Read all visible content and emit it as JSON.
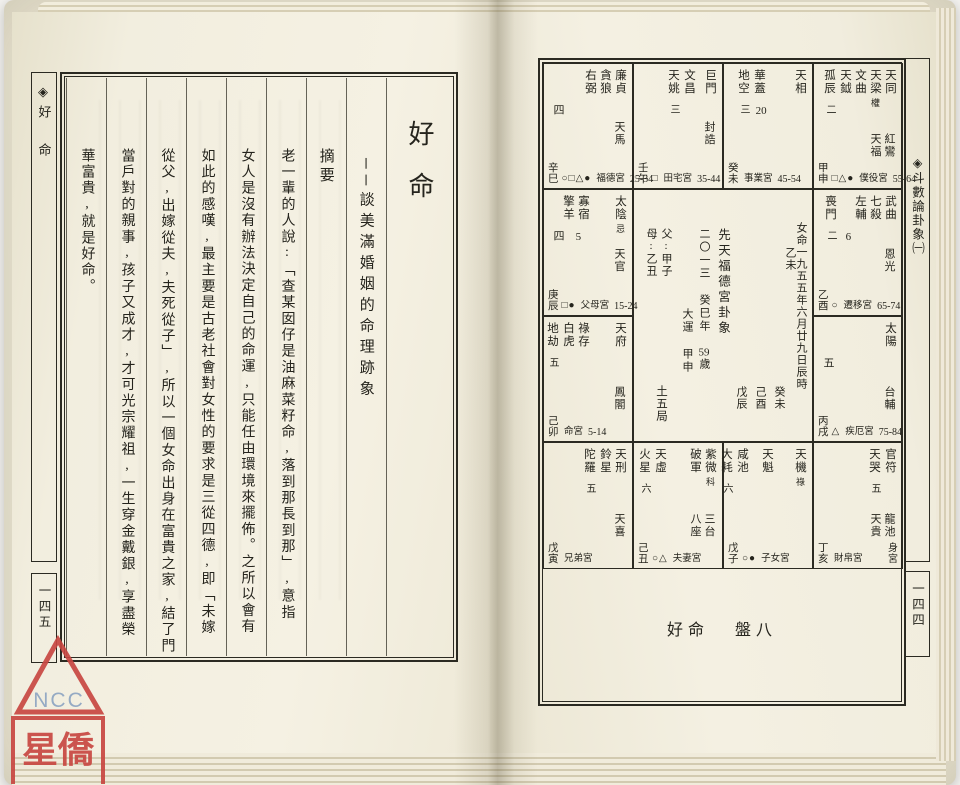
{
  "left_page": {
    "margin_label": "◈好 命",
    "page_number": "一四五",
    "title": "好命",
    "subtitle": "──談美滿婚姻的命理跡象",
    "section_header": "摘要",
    "body_columns": [
      "老一輩的人說:「查某囡仔是油麻菜籽命,落到那長到那」,意指",
      "女人是沒有辦法決定自己的命運,只能任由環境來擺佈。之所以會有",
      "如此的感嘆,最主要是古老社會對女性的要求是三從四德,即「未嫁",
      "從父,出嫁從夫,夫死從子」,所以一個女命出身在富貴之家,結了門",
      "當戶對的親事,孩子又成才,才可光宗耀祖,一生穿金戴銀,享盡榮",
      "華富貴,就是好命。"
    ]
  },
  "right_page": {
    "margin_label": "◈斗數論卦象㈠",
    "page_number": "一四四",
    "caption_title": "好命",
    "caption_plate": "盤八",
    "chart": {
      "center": {
        "birth_info": "女命一九五五年六月廿九日辰時",
        "year_pillar": "乙未",
        "pillars": [
          "癸未",
          "己酉",
          "戊辰"
        ],
        "heading": "先天福德宮卦象",
        "flow_year": "二〇一三 癸巳年",
        "age": "59",
        "age_suffix": "歲",
        "decade_label": "大運",
        "decade_ganzhi": "甲申",
        "father": "父:甲子",
        "mother": "母:乙丑",
        "bureau": "土五局"
      },
      "palaces": [
        {
          "col": 0,
          "row": 0,
          "gz": "辛巳",
          "stars": [
            {
              "t": "廉貞"
            },
            {
              "t": "貪狼"
            },
            {
              "t": "右弼"
            }
          ],
          "extras": [
            {
              "t": "四",
              "pos": "tl"
            },
            {
              "t": "天馬",
              "pos": "mr"
            }
          ],
          "syms": "○□△●",
          "palace": "福德宮",
          "range": "25-34"
        },
        {
          "col": 1,
          "row": 0,
          "gz": "壬午",
          "stars": [
            {
              "t": "巨門",
              "gap": 6
            },
            {
              "t": "文昌"
            },
            {
              "t": "天姚",
              "num": "三"
            }
          ],
          "extras": [
            {
              "t": "封誥",
              "pos": "mr"
            }
          ],
          "syms": "□",
          "palace": "田宅宮",
          "range": "35-44"
        },
        {
          "col": 2,
          "row": 0,
          "gz": "癸未",
          "stars": [
            {
              "t": "天相",
              "gap": 26
            },
            {
              "t": "華蓋"
            },
            {
              "t": "地空",
              "num": "三"
            }
          ],
          "extras": [
            {
              "t": "20",
              "pos": "tm"
            }
          ],
          "syms": "",
          "palace": "事業宮",
          "range": "45-54"
        },
        {
          "col": 3,
          "row": 0,
          "gz": "甲申",
          "stars": [
            {
              "t": "天同"
            },
            {
              "t": "天梁",
              "sub": "權"
            },
            {
              "t": "文曲"
            },
            {
              "t": "天鉞"
            },
            {
              "t": "孤辰",
              "num": "二"
            }
          ],
          "extras": [
            {
              "t": "紅鸞",
              "pos": "lr"
            },
            {
              "t": "天福",
              "pos": "lr2"
            }
          ],
          "syms": "□△●",
          "palace": "僕役宮",
          "range": "55-64"
        },
        {
          "col": 0,
          "row": 1,
          "gz": "庚辰",
          "stars": [
            {
              "t": "太陰",
              "sub": "忌",
              "gap": 22
            },
            {
              "t": "寡宿"
            },
            {
              "t": "擎羊"
            }
          ],
          "extras": [
            {
              "t": "四",
              "pos": "tl"
            },
            {
              "t": "5",
              "pos": "tm"
            },
            {
              "t": "天官",
              "pos": "mr"
            }
          ],
          "syms": "□●",
          "palace": "父母宮",
          "range": "15-24"
        },
        {
          "col": 3,
          "row": 1,
          "gz": "乙酉",
          "stars": [
            {
              "t": "武曲"
            },
            {
              "t": "七殺"
            },
            {
              "t": "左輔",
              "gap": 14
            },
            {
              "t": "喪門",
              "num": "二"
            }
          ],
          "extras": [
            {
              "t": "6",
              "pos": "tm"
            },
            {
              "t": "恩光",
              "pos": "mr"
            }
          ],
          "syms": "○",
          "palace": "遷移宮",
          "range": "65-74"
        },
        {
          "col": 0,
          "row": 2,
          "gz": "己卯",
          "stars": [
            {
              "t": "天府",
              "gap": 22
            },
            {
              "t": "祿存"
            },
            {
              "t": "白虎"
            },
            {
              "t": "地劫",
              "num": "五"
            }
          ],
          "extras": [
            {
              "t": "鳳閣",
              "pos": "lr"
            }
          ],
          "syms": "",
          "palace": "命宮",
          "range": "5-14"
        },
        {
          "col": 3,
          "row": 2,
          "gz": "丙戌",
          "stars": [
            {
              "t": "太陽"
            }
          ],
          "extras": [
            {
              "t": "五",
              "pos": "tl"
            },
            {
              "t": "台輔",
              "pos": "lr"
            }
          ],
          "syms": "△",
          "palace": "疾厄宮",
          "range": "75-84"
        },
        {
          "col": 0,
          "row": 3,
          "gz": "戊寅",
          "stars": [
            {
              "t": "天刑"
            },
            {
              "t": "鈴星"
            },
            {
              "t": "陀羅",
              "num": "五"
            }
          ],
          "extras": [
            {
              "t": "天喜",
              "pos": "lr"
            }
          ],
          "syms": "",
          "palace": "兄弟宮",
          "range": ""
        },
        {
          "col": 1,
          "row": 3,
          "gz": "己丑",
          "stars": [
            {
              "t": "紫微",
              "sub": "科"
            },
            {
              "t": "破軍",
              "gap": 20
            },
            {
              "t": "天虛"
            },
            {
              "t": "火星",
              "num": "六"
            }
          ],
          "extras": [
            {
              "t": "三台",
              "pos": "lr"
            },
            {
              "t": "八座",
              "pos": "lr2"
            }
          ],
          "syms": "○△",
          "palace": "夫妻宮",
          "range": ""
        },
        {
          "col": 2,
          "row": 3,
          "gz": "戊子",
          "stars": [
            {
              "t": "天機",
              "sub": "祿",
              "gap": 18
            },
            {
              "t": "天魁",
              "gap": 10
            },
            {
              "t": "咸池"
            },
            {
              "t": "大耗",
              "num": "六"
            }
          ],
          "extras": [],
          "syms": "○●",
          "palace": "子女宮",
          "range": ""
        },
        {
          "col": 3,
          "row": 3,
          "gz": "丁亥",
          "stars": [
            {
              "t": "官符"
            },
            {
              "t": "天哭",
              "num": "五"
            }
          ],
          "extras": [
            {
              "t": "龍池",
              "pos": "lr"
            },
            {
              "t": "天貴",
              "pos": "lr2"
            }
          ],
          "syms": "",
          "palace": "財帛宮",
          "range": "",
          "body": "身宮"
        }
      ]
    }
  },
  "stamp": {
    "letters": "NCC",
    "name": "星僑",
    "red": "#c84742",
    "blue": "#8ea5c2"
  }
}
